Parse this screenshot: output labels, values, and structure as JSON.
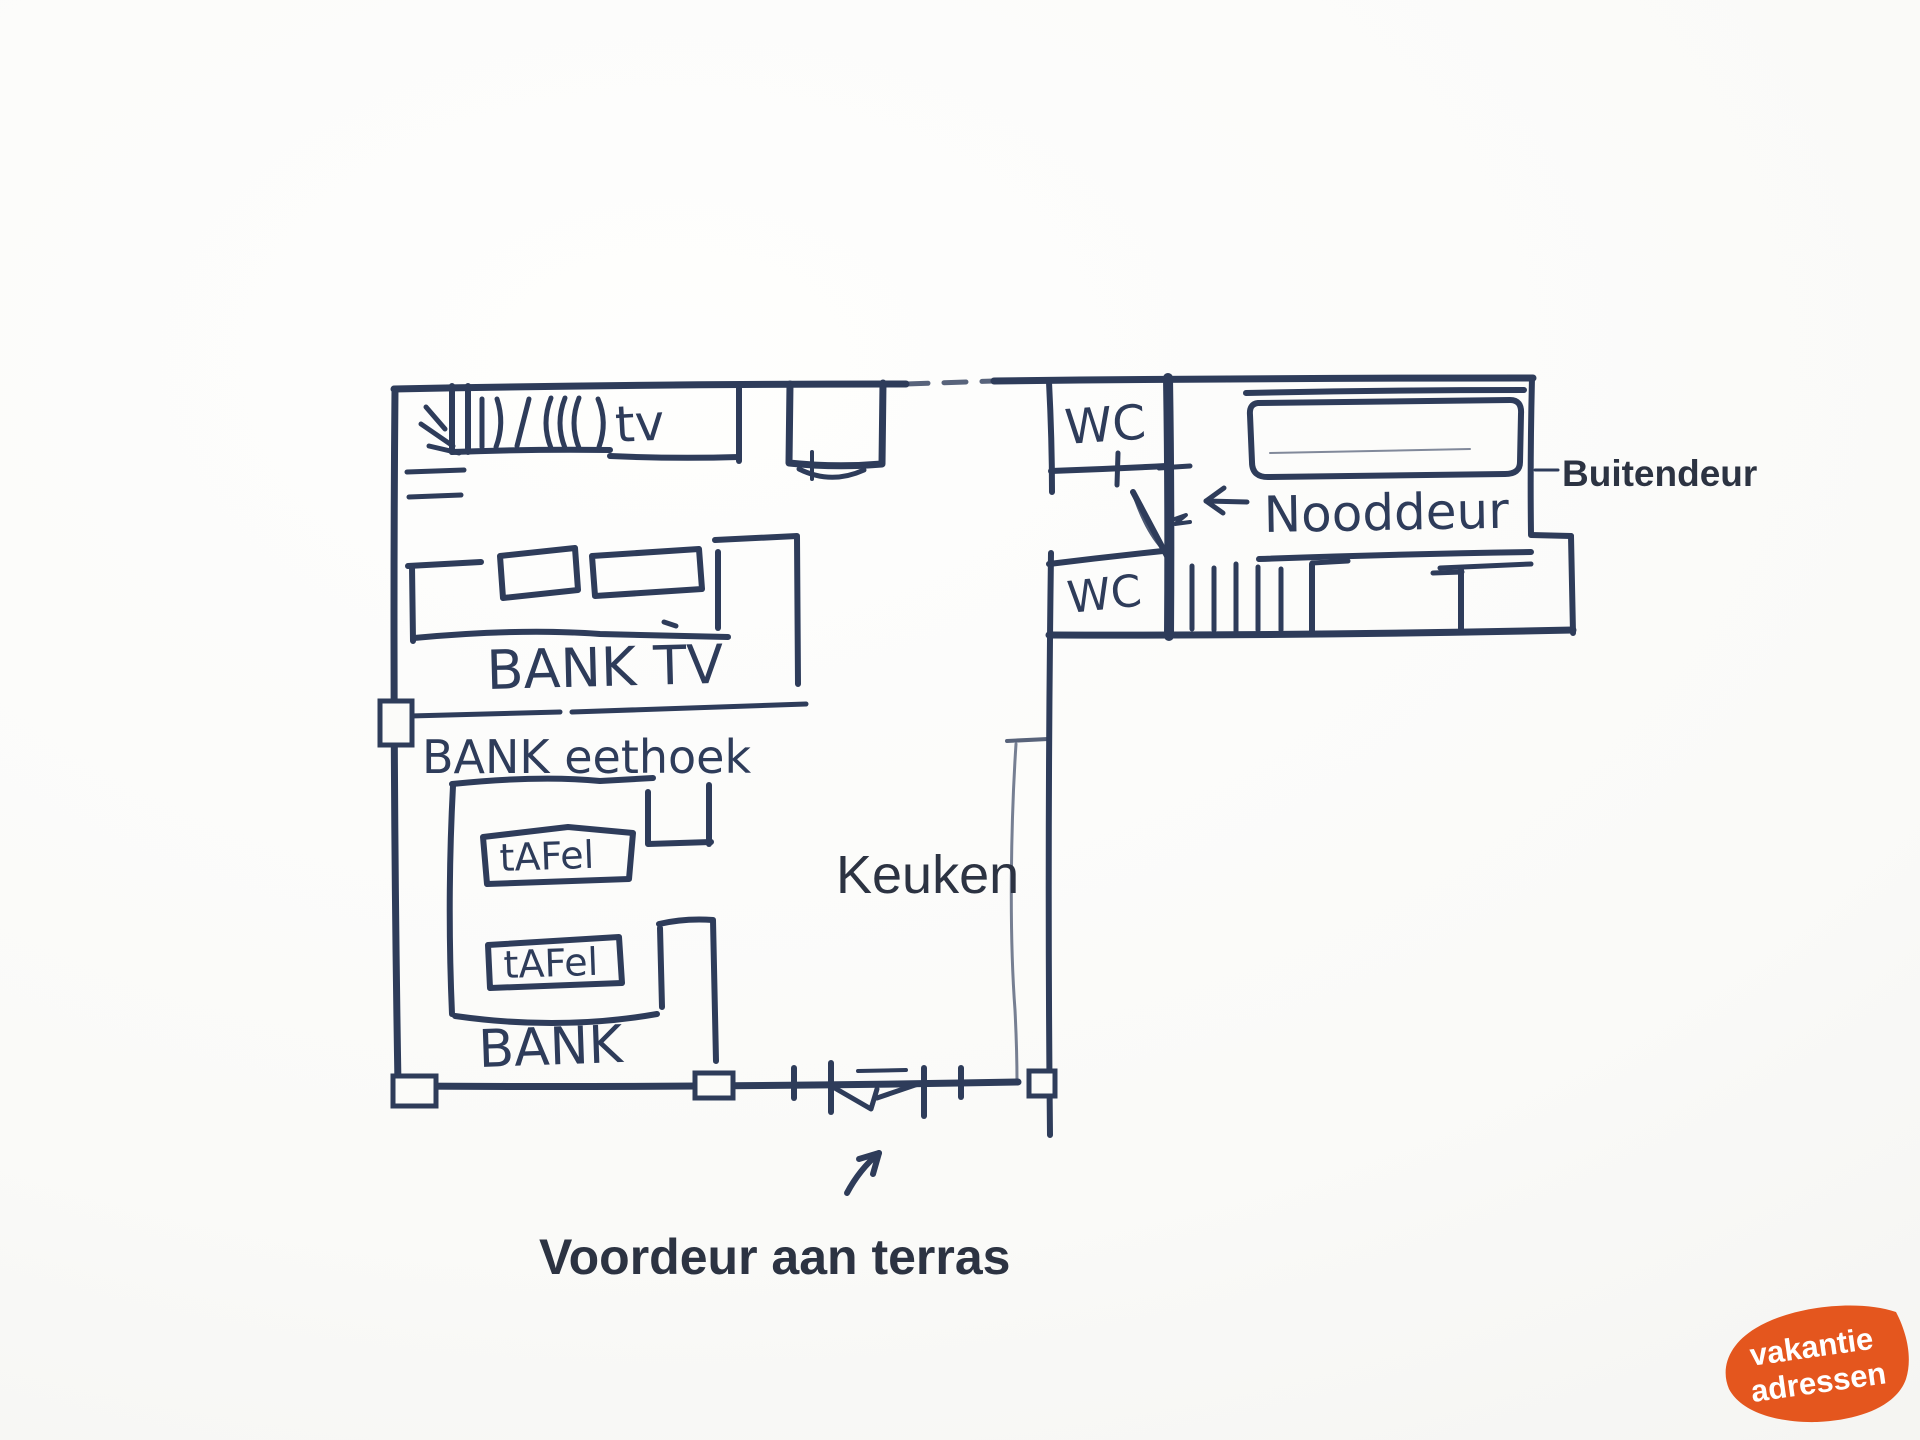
{
  "page": {
    "background": "#fafaf8",
    "ink_color": "#2e3c5a",
    "print_color": "#2c3342"
  },
  "plan": {
    "rooms": {
      "keuken_label": "Keuken",
      "wc_top_label": "WC",
      "wc_bottom_label": "WC"
    },
    "doors": {
      "nooddeur_label": "Nooddeur",
      "buitendeur_label": "Buitendeur",
      "voordeur_label": "Voordeur aan terras"
    },
    "furniture": {
      "tv_label": "tv",
      "bank_tv_label": "BANK TV",
      "bank_eethoek_label": "BANK eethoek",
      "tafel1_label": "tAFel",
      "tafel2_label": "tAFel",
      "bank_label": "BANK"
    }
  },
  "logo": {
    "line1": "vakantie",
    "line2": "adressen",
    "background_color": "#e4561e",
    "text_color": "#ffffff"
  }
}
